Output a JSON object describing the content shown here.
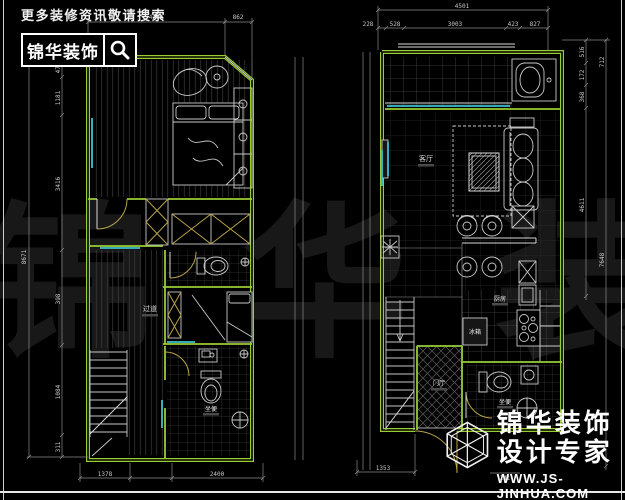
{
  "branding": {
    "search_hint": "更多装修资讯敬请搜索",
    "logo_text": "锦华装饰"
  },
  "watermark": {
    "text": "锦 华 装 饰"
  },
  "footer": {
    "brand": "锦华装饰",
    "tagline": "设计专家",
    "url": "WWW.JS-JINHUA.COM"
  },
  "left_plan": {
    "dims": {
      "top": [
        "4284",
        "862"
      ],
      "bottom": [
        "1378",
        "2400"
      ],
      "left_total": "8671",
      "left_segments": [
        "475",
        "1181",
        "3416",
        "398",
        "1084",
        "311"
      ]
    },
    "labels": {
      "corridor": "过道",
      "bathroom": "坐便"
    }
  },
  "right_plan": {
    "dims": {
      "top_total": "4501",
      "top_segments": [
        "228",
        "528",
        "3003",
        "423",
        "827"
      ],
      "right_inner": [
        "516",
        "172",
        "368",
        "4611"
      ],
      "right_outer": [
        "712",
        "7648"
      ],
      "bottom": [
        "1353",
        "241"
      ]
    },
    "labels": {
      "living": "客厅",
      "fridge": "冰箱",
      "entry": "门厅",
      "kitchen": "厨房",
      "bath": "坐便"
    }
  },
  "colors": {
    "wall": "#9acd32",
    "window": "#3cc1d3",
    "door": "#b9a24a",
    "line": "#c9c9c9",
    "dim": "#8a8a8a",
    "bg": "#000000",
    "watermark": "#181818"
  }
}
